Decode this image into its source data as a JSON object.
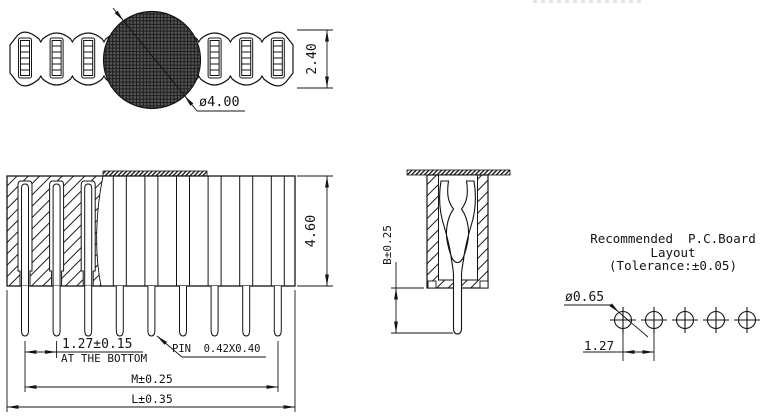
{
  "top_view": {
    "height_dim": "2.40",
    "tape_hole_dia_dim": "ø4.00"
  },
  "side_view": {
    "height_dim": "4.60",
    "pin_pitch_dim": "1.27±0.15",
    "pin_pitch_note": "AT THE BOTTOM",
    "pin_size_label": "PIN  0.42X0.40",
    "pin_span_dim": "M±0.25",
    "overall_length_dim": "L±0.35"
  },
  "section_view": {
    "pin_protrusion_dim": "B±0.25"
  },
  "pcb_layout": {
    "title_line1": "Recommended  P.C.Board",
    "title_line2": "Layout",
    "title_line3": "(Tolerance:±0.05)",
    "hole_dia_dim": "ø0.65",
    "hole_pitch_dim": "1.27"
  }
}
